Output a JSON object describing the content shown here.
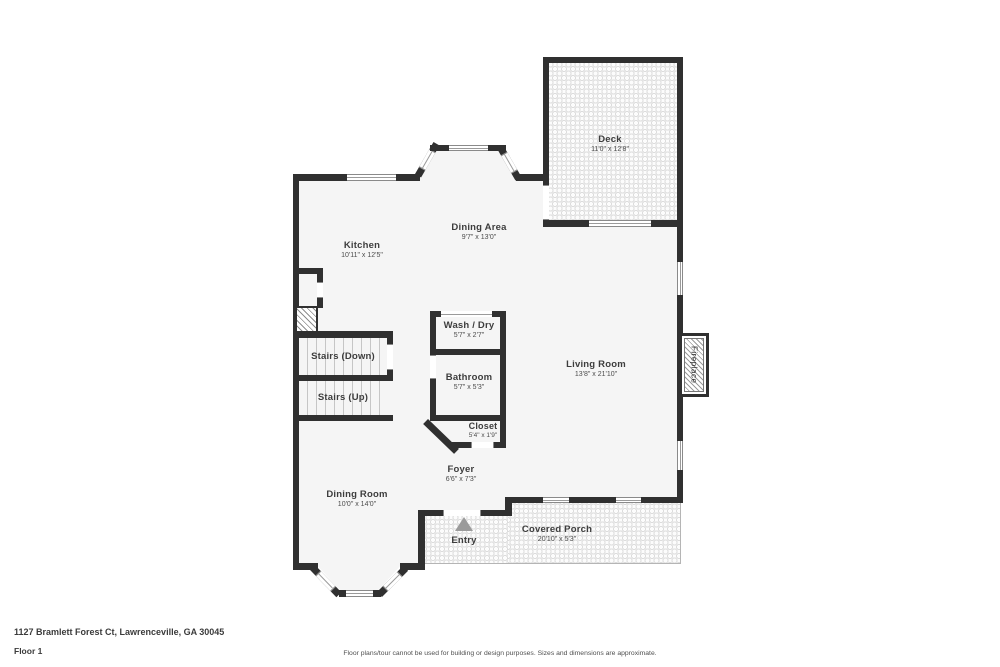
{
  "colors": {
    "wall": "#303030",
    "floor_fill": "#f5f5f5",
    "pattern_dot": "#dcdcdc",
    "label_text": "#3d3d3d",
    "entry_arrow": "#9b9b9b"
  },
  "rooms": {
    "deck": {
      "name": "Deck",
      "dims": "11'0\" x 12'8\""
    },
    "dining_area": {
      "name": "Dining Area",
      "dims": "9'7\" x 13'0\""
    },
    "kitchen": {
      "name": "Kitchen",
      "dims": "10'11\" x 12'5\""
    },
    "wash_dry": {
      "name": "Wash / Dry",
      "dims": "5'7\" x 2'7\""
    },
    "bathroom": {
      "name": "Bathroom",
      "dims": "5'7\" x 5'3\""
    },
    "living_room": {
      "name": "Living Room",
      "dims": "13'8\" x 21'10\""
    },
    "stairs_down": {
      "name": "Stairs (Down)"
    },
    "stairs_up": {
      "name": "Stairs (Up)"
    },
    "closet": {
      "name": "Closet",
      "dims": "5'4\" x 1'9\""
    },
    "foyer": {
      "name": "Foyer",
      "dims": "6'6\" x 7'3\""
    },
    "dining_room": {
      "name": "Dining Room",
      "dims": "10'0\" x 14'0\""
    },
    "entry": {
      "name": "Entry"
    },
    "covered_porch": {
      "name": "Covered Porch",
      "dims": "20'10\" x 5'3\""
    },
    "fireplace": {
      "name": "Fireplace"
    }
  },
  "footer": {
    "address": "1127 Bramlett Forest Ct, Lawrenceville, GA 30045",
    "floor_label": "Floor 1",
    "disclaimer": "Floor plans/tour cannot be used for building or design purposes. Sizes and dimensions are approximate."
  }
}
